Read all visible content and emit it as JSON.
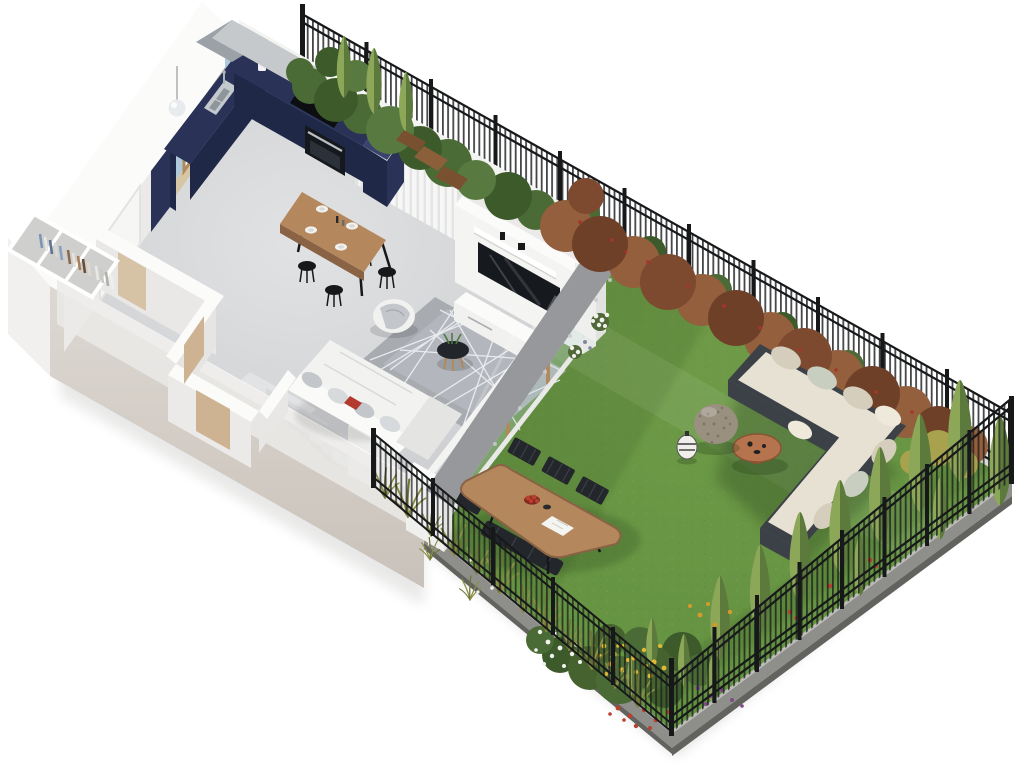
{
  "scene": {
    "title": "3D isometric cutaway floor plan of a garden apartment with fenced private yard",
    "view": "bird's-eye axonometric architectural render",
    "background": "#ffffff"
  },
  "colors": {
    "bg": "#ffffff",
    "wallWhite": "#f3f3f1",
    "wallTop": "#fbfbfa",
    "wallInner": "#ebeae8",
    "wallLip": "#9ba1a7",
    "facade": "#d9d3cc",
    "facadeDark": "#c7c0b8",
    "westFacade": "#f1f0ee",
    "floor": "#cccdd0",
    "floorLight": "#e0e1e3",
    "navy": "#2a3357",
    "navyDark": "#1f2847",
    "navyLight": "#39436e",
    "blueWall": "#afc9da",
    "splash": "#6f93ad",
    "beige": "#d5c6a6",
    "wood": "#b08a5c",
    "woodDark": "#8a6244",
    "tableWood": "#b5875c",
    "steel": "#c4c9cd",
    "dark": "#17181a",
    "curtain": "#f7f7f6",
    "curtainShade": "#e3e4e6",
    "rug": "#a8acb1",
    "rugLight": "#babec4",
    "rugLine": "#eef1f3",
    "sofa": "#f2f2f0",
    "sofaShade": "#e4e4e2",
    "pillow": "#c3c7cb",
    "pillowLight": "#d7dadd",
    "bookRed": "#b33a2e",
    "tvDark": "#16191e",
    "stepA": "#d8d9db",
    "stepB": "#cfd1d3",
    "riser": "#b9bbbd",
    "landing": "#e2e3e4",
    "lawn": "#5f8f3e",
    "lawnLight": "#79a34d",
    "lawnDark": "#2e4a1f",
    "paving": "#96989b",
    "pavingDot": "#c9cbcd",
    "soil": "#8e8e8a",
    "soilDark": "#62625e",
    "curbLight": "#bdbdb8",
    "fence": "#17181a",
    "cypLight": "#8ba757",
    "cypDark": "#5d7a3d",
    "shrubG": "#4a6b35",
    "shrubGD": "#3d5a2b",
    "shrubG2": "#587a40",
    "shrubR": "#935f3d",
    "shrubRD": "#6f4028",
    "shrubR2": "#7d4a30",
    "berry": "#a8342a",
    "bushYellow": "#a8a24f",
    "cream": "#e7e1d4",
    "creamShade": "#d5cebd",
    "sage": "#c8cfc0",
    "frame": "#3c4148",
    "copper": "#b5744e",
    "copperDark": "#8a5434",
    "stone": "#9a9080",
    "stoneDot": "#6e6658",
    "lantern": "#efeeea",
    "fYellow": "#e0ba32",
    "fOrange": "#d69a2b",
    "fWhite": "#f2f2ec",
    "fRed": "#b8402e",
    "fPurple": "#7d4a86",
    "grass": "#8a8f45",
    "grassDark": "#6f7436",
    "chair": "#23262a",
    "benchWood": "#8a5f3a",
    "benchWoodDark": "#7a5130",
    "glass": "#bcd6cc",
    "door": "#cdb392",
    "doorLight": "#d6c2a4",
    "doorFrame": "#e3e3e1",
    "shadow": "#3a3a34"
  },
  "house": {
    "label": "Apartment interior (cutaway view)",
    "rooms": [
      {
        "id": "entrance-hall",
        "label": "Entrance hall",
        "items": [
          "front door",
          "open wardrobe with hanging clothes"
        ]
      },
      {
        "id": "kitchen",
        "label": "Kitchen",
        "items": [
          "navy L-shaped cabinets",
          "steel sink",
          "black cooktop",
          "built-in oven",
          "tall navy cabinet",
          "window with wooden frame",
          "pendant lamp",
          "light-blue splashback wall",
          "beige wall band"
        ]
      },
      {
        "id": "dining-area",
        "label": "Dining area",
        "items": [
          "wooden table",
          "four black stools",
          "four place settings",
          "sheer curtains"
        ]
      },
      {
        "id": "living-room",
        "label": "Living room",
        "items": [
          "white corner sofa",
          "round pouf with grey throw",
          "black round coffee table",
          "grey rug with white geometric lines",
          "TV on tall white media wall",
          "white media console",
          "glass wall to garden with wooden mullions"
        ]
      },
      {
        "id": "hallway",
        "label": "Inner hallway",
        "items": [
          "white partition walls",
          "tan interior doors"
        ]
      },
      {
        "id": "staircase",
        "label": "Staircase",
        "items": [
          "concrete steps",
          "white balustrade wall"
        ]
      }
    ]
  },
  "garden": {
    "label": "Private fenced garden",
    "items": [
      {
        "id": "lawn",
        "label": "Lawn"
      },
      {
        "id": "outdoor-sofa",
        "label": "L-shaped outdoor lounge sofa with cream cushions"
      },
      {
        "id": "outdoor-coffee-table",
        "label": "Round copper coffee table"
      },
      {
        "id": "rattan-sphere",
        "label": "Decorative rattan sphere"
      },
      {
        "id": "lantern",
        "label": "Outdoor lantern"
      },
      {
        "id": "outdoor-dining",
        "label": "Oval wooden dining table with black chairs and bench"
      },
      {
        "id": "fruit-bowl",
        "label": "Bowl of red fruit"
      },
      {
        "id": "magazine",
        "label": "Open magazine"
      },
      {
        "id": "paving",
        "label": "Stone paving strip with white hydrangeas"
      },
      {
        "id": "garden-bench-set",
        "label": "Wooden bench set among the shrubs"
      }
    ],
    "planting": [
      {
        "id": "shrub-row",
        "label": "Copper-red and green shrubs along the back fence"
      },
      {
        "id": "cypress-corner",
        "label": "Conifers at the north corner"
      },
      {
        "id": "cypress-row",
        "label": "Row of cypress trees along the east fence"
      },
      {
        "id": "flower-bed",
        "label": "Yellow, white, red and purple flower bed at the south corner"
      },
      {
        "id": "grass-tufts",
        "label": "Ornamental grasses along the south-west fence"
      }
    ],
    "fence": {
      "label": "Black metal picket fence on a concrete curb"
    }
  }
}
